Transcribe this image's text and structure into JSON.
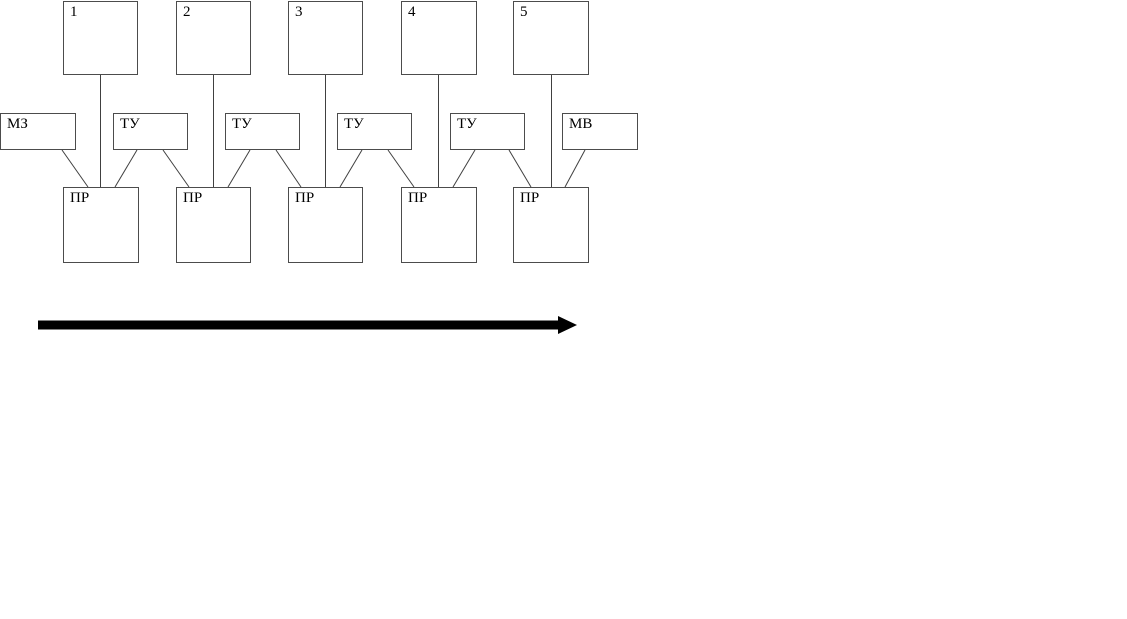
{
  "diagram": {
    "top_row": [
      {
        "label": "1"
      },
      {
        "label": "2"
      },
      {
        "label": "3"
      },
      {
        "label": "4"
      },
      {
        "label": "5"
      }
    ],
    "middle_row": [
      {
        "label": "МЗ"
      },
      {
        "label": "ТУ"
      },
      {
        "label": "ТУ"
      },
      {
        "label": "ТУ"
      },
      {
        "label": "ТУ"
      },
      {
        "label": "МВ"
      }
    ],
    "bottom_row": [
      {
        "label": "ПР"
      },
      {
        "label": "ПР"
      },
      {
        "label": "ПР"
      },
      {
        "label": "ПР"
      },
      {
        "label": "ПР"
      }
    ],
    "arrow": {
      "direction": "right"
    },
    "colors": {
      "background": "#ffffff",
      "box_border": "#4c4c4c",
      "connector": "#404040",
      "arrow": "#000000",
      "text": "#000000"
    }
  }
}
